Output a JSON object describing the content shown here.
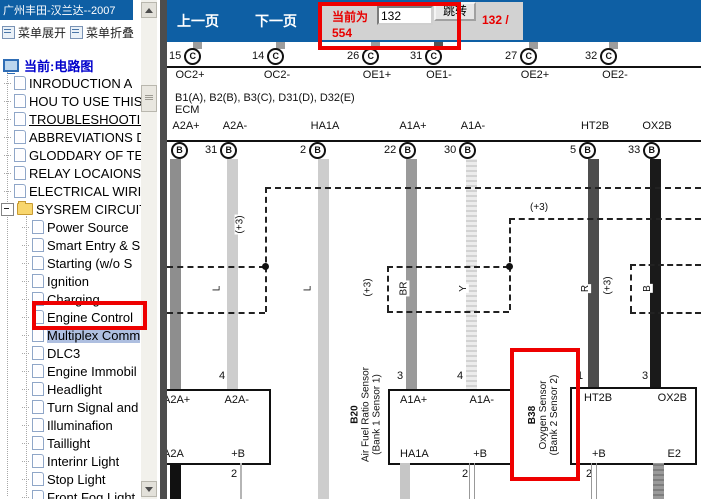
{
  "window": {
    "title": "广州丰田-汉兰达--2007"
  },
  "sidebar": {
    "menu_expand": "菜单展开",
    "menu_collapse": "菜单折叠",
    "root_label": "当前:电路图",
    "doc_items": [
      "INRODUCTION A",
      "HOU TO USE THIS",
      "TROUBLESHOOTIN",
      "ABBREVIATIONS D",
      "GLODDARY OF TER",
      "RELAY LOCAIONS",
      "ELECTRICAL WIRII"
    ],
    "folder_label": "SYSREM CIRCUITS",
    "circuit_items": [
      "Power Source",
      "Smart Entry & S",
      "Starting (w/o S",
      "Ignition",
      "Charging",
      "Engine Control",
      "Multiplex Comm",
      "DLC3",
      "Engine Immobil",
      "Headlight",
      "Turn Signal and",
      "Illuminafion",
      "Taillight",
      "Interinr Light",
      "Stop Light",
      "Front Fog Light"
    ]
  },
  "toolbar": {
    "prev_label": "上一页",
    "next_label": "下一页",
    "current_label": "当前为",
    "page_input": "132",
    "jump_label": "跳转",
    "page_fraction": "132 /",
    "page_total": "554"
  },
  "diagram": {
    "ecm_connectors": "B1(A), B2(B), B3(C), D31(D), D32(E)",
    "ecm_label": "ECM",
    "pin_letter_c": "C",
    "pin_letter_b": "B",
    "c_pins": [
      {
        "num": "15",
        "label": "OC2+"
      },
      {
        "num": "14",
        "label": "OC2-"
      },
      {
        "num": "26",
        "label": "OE1+"
      },
      {
        "num": "31",
        "label": "OE1-"
      },
      {
        "num": "27",
        "label": "OE2+"
      },
      {
        "num": "32",
        "label": "OE2-"
      }
    ],
    "b_pins": [
      {
        "num": "",
        "label": "A2A+",
        "color": ""
      },
      {
        "num": "31",
        "label": "A2A-",
        "color": "L"
      },
      {
        "num": "2",
        "label": "HA1A",
        "color": "L"
      },
      {
        "num": "22",
        "label": "A1A+",
        "color": "BR"
      },
      {
        "num": "30",
        "label": "A1A-",
        "color": "Y"
      },
      {
        "num": "5",
        "label": "HT2B",
        "color": "R"
      },
      {
        "num": "33",
        "label": "OX2B",
        "color": "B"
      }
    ],
    "shield_label": "(+3)",
    "box1": {
      "tl": "A2A+",
      "tr": "A2A-",
      "bl": "A2A",
      "br": "+B",
      "pin_top": "4",
      "pin_bottom": "2"
    },
    "box2": {
      "id": "B20",
      "name": "Air Fuel Ratio Sensor",
      "sub": "(Bank 1 Sensor 1)",
      "tl": "A1A+",
      "tr": "A1A-",
      "bl": "HA1A",
      "br": "+B",
      "pin_top_l": "3",
      "pin_top_r": "4",
      "pin_bottom_l": "1",
      "pin_bottom_r": "2"
    },
    "box3": {
      "id": "B38",
      "name": "Oxygen Sensor",
      "sub": "(Bank 2 Sensor 2)",
      "tl": "HT2B",
      "tr": "OX2B",
      "bl": "+B",
      "br": "E2",
      "pin_top_l": "1",
      "pin_top_r": "3",
      "pin_bottom_l": "2",
      "pin_bottom_r": "4"
    }
  },
  "colors": {
    "toolbar_blue": "#0e5fa4",
    "annotation_red": "#ee0000",
    "red_text": "#e80000",
    "selected_item_bg": "#aebfe0"
  }
}
